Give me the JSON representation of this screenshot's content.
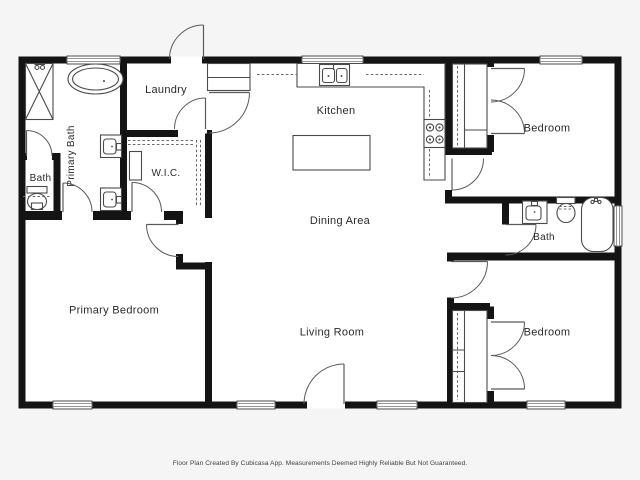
{
  "plan": {
    "title": "Floor Plan",
    "rooms": {
      "primary_bath": "Primary Bath",
      "bath_left": "Bath",
      "laundry": "Laundry",
      "wic": "W.I.C.",
      "kitchen": "Kitchen",
      "dining": "Dining Area",
      "living": "Living Room",
      "primary_bedroom": "Primary Bedroom",
      "bedroom_top_right": "Bedroom",
      "bath_right": "Bath",
      "bedroom_bottom_right": "Bedroom"
    },
    "fixtures": [
      "shower",
      "bathtub",
      "toilet",
      "vanity-sink",
      "kitchen-sink",
      "stove",
      "kitchen-island",
      "pantry",
      "closet-rod"
    ],
    "counts": {
      "bedrooms": 3,
      "bathrooms": 3,
      "windows": 8,
      "exterior_doors": 2
    }
  },
  "footer": {
    "disclaimer": "Floor Plan Created By Cubicasa App. Measurements Deemed Highly Reliable But Not Guaranteed."
  },
  "colors": {
    "wall": "#141414",
    "fixture_line": "#4a4a4a",
    "label_text": "#2b2b2b",
    "floor": "#ffffff",
    "background": "#f5f5f5"
  }
}
